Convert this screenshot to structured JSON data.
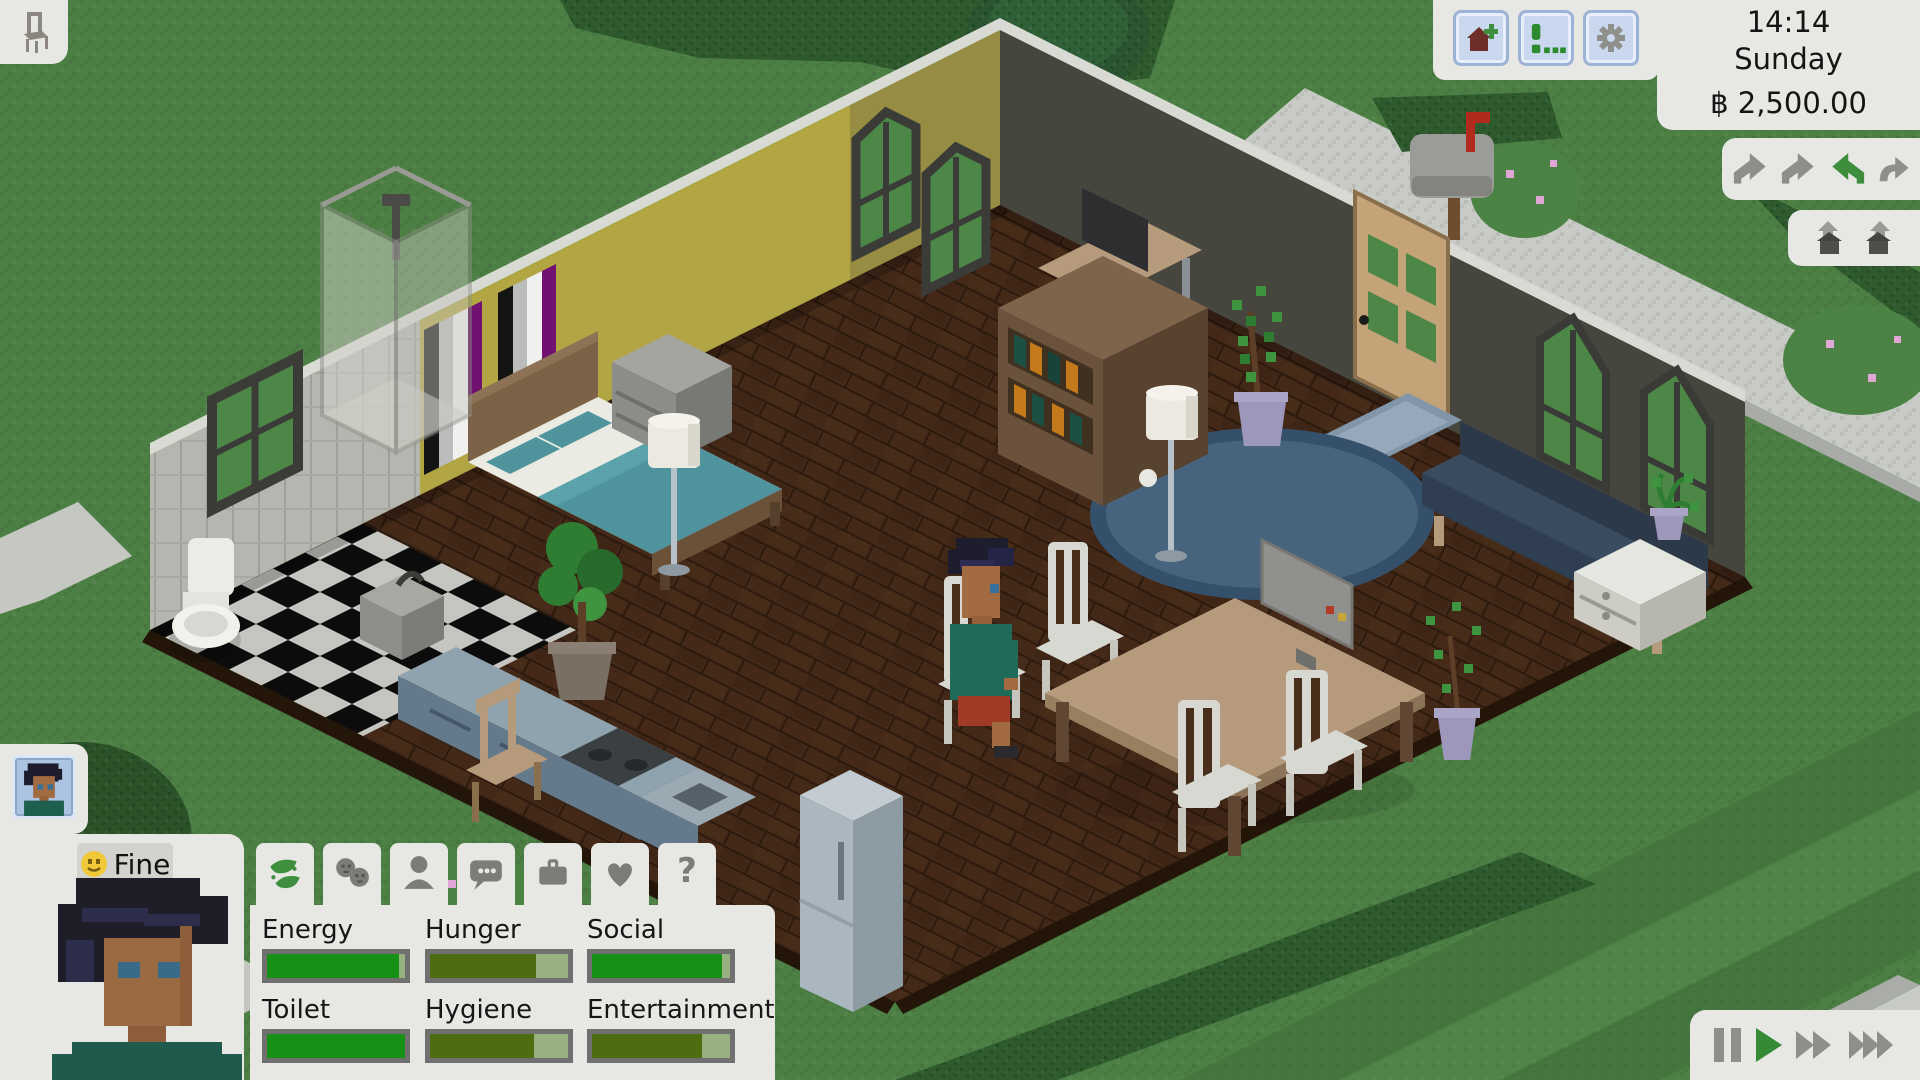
{
  "hud": {
    "build_mode_button": {
      "icon": "chair-icon"
    },
    "top_bar": {
      "buttons": [
        {
          "id": "build-house",
          "icon": "house-plus-icon"
        },
        {
          "id": "notifications",
          "icon": "exclamation-dots-icon"
        },
        {
          "id": "settings",
          "icon": "gear-icon"
        }
      ],
      "clock": {
        "time": "14:14",
        "day": "Sunday",
        "funds": "฿ 2,500.00"
      }
    },
    "camera_panel": {
      "icons": [
        "rotate-left-icon",
        "rotate-left-icon",
        "rotate-active-icon",
        "rotate-right-icon"
      ],
      "active_color": "#3e8e3e"
    },
    "floor_panel": {
      "icons": [
        "wall-up-icon",
        "roof-up-icon"
      ]
    },
    "playback": {
      "buttons": [
        {
          "id": "pause"
        },
        {
          "id": "play"
        },
        {
          "id": "fast-forward"
        },
        {
          "id": "fastest"
        }
      ],
      "active": "play",
      "active_color": "#358a35"
    }
  },
  "character": {
    "mood": {
      "emoji": "smiley-face",
      "label": "Fine"
    },
    "tabs": [
      {
        "id": "needs",
        "icon": "leaf-icon",
        "active": true
      },
      {
        "id": "relationships",
        "icon": "people-icon",
        "active": false
      },
      {
        "id": "character",
        "icon": "person-icon",
        "active": false
      },
      {
        "id": "social",
        "icon": "speech-bubble-icon",
        "active": false
      },
      {
        "id": "career",
        "icon": "briefcase-icon",
        "active": false
      },
      {
        "id": "romance",
        "icon": "heart-icon",
        "active": false
      },
      {
        "id": "help",
        "icon": "question-icon",
        "glyph": "?",
        "active": false
      }
    ],
    "needs": {
      "items": [
        {
          "label": "Energy",
          "value": 96,
          "fill_color": "#169116"
        },
        {
          "label": "Hunger",
          "value": 77,
          "fill_color": "#4c6d10"
        },
        {
          "label": "Social",
          "value": 94,
          "fill_color": "#169116"
        },
        {
          "label": "Toilet",
          "value": 100,
          "fill_color": "#169116"
        },
        {
          "label": "Hygiene",
          "value": 75,
          "fill_color": "#4c6d10"
        },
        {
          "label": "Entertainment",
          "value": 80,
          "fill_color": "#4c6d10"
        }
      ],
      "track_color": "#97b181",
      "border_color": "#707070"
    }
  },
  "scene": {
    "style": "isometric-pixel-art",
    "rooms": [
      "bedroom",
      "bathroom",
      "living-room",
      "dining-area",
      "kitchen"
    ],
    "objects": [
      "bed",
      "dresser",
      "pride-banners",
      "arched-windows",
      "shower",
      "toilet",
      "bathroom-sink",
      "bathroom-window",
      "bookshelf",
      "desk-computer",
      "front-door",
      "doormat",
      "couch",
      "living-windows",
      "white-cabinet",
      "potted-plants",
      "rug",
      "dining-table",
      "white-chairs",
      "table-computer",
      "floor-lamps",
      "kitchen-counter",
      "stove",
      "kitchen-sink",
      "stool",
      "fridge",
      "tree",
      "mailbox",
      "hedges",
      "flower-bushes",
      "sidewalk",
      "lawn"
    ],
    "occupants": [
      {
        "activity": "sitting-at-dining-table"
      }
    ]
  }
}
